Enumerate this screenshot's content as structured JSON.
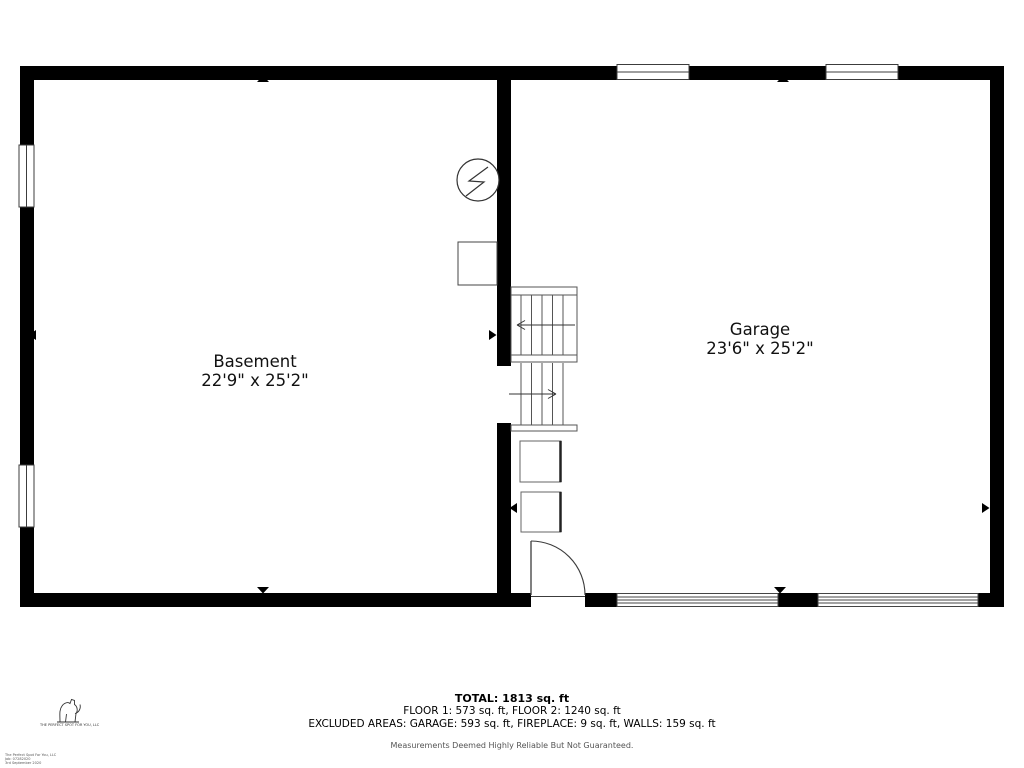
{
  "floor_plan": {
    "rooms": [
      {
        "name": "Basement",
        "dimensions": "22'9\" x 25'2\""
      },
      {
        "name": "Garage",
        "dimensions": "23'6\" x 25'2\""
      }
    ],
    "features": [
      "stairs-up",
      "stairs-down",
      "entry-door",
      "garage-doors",
      "windows",
      "electrical-meter",
      "utility-box"
    ]
  },
  "summary": {
    "total": "TOTAL: 1813 sq. ft",
    "floors": "FLOOR 1: 573 sq. ft, FLOOR 2: 1240 sq. ft",
    "excluded_areas": "EXCLUDED AREAS: GARAGE: 593 sq. ft, FIREPLACE: 9 sq. ft, WALLS: 159 sq. ft",
    "disclaimer": "Measurements Deemed Highly Reliable But Not Guaranteed."
  },
  "branding": {
    "company": "THE PERFECT SPOT FOR YOU, LLC",
    "fine_print_line1": "The Perfect Spot For You, LLC",
    "fine_print_line2": "Job: 07282020",
    "fine_print_line3": "3rd September 2020"
  },
  "colors": {
    "wall": "#000000",
    "fixture_line": "#3c3c3c",
    "muted_text": "#555555",
    "background": "#ffffff"
  }
}
